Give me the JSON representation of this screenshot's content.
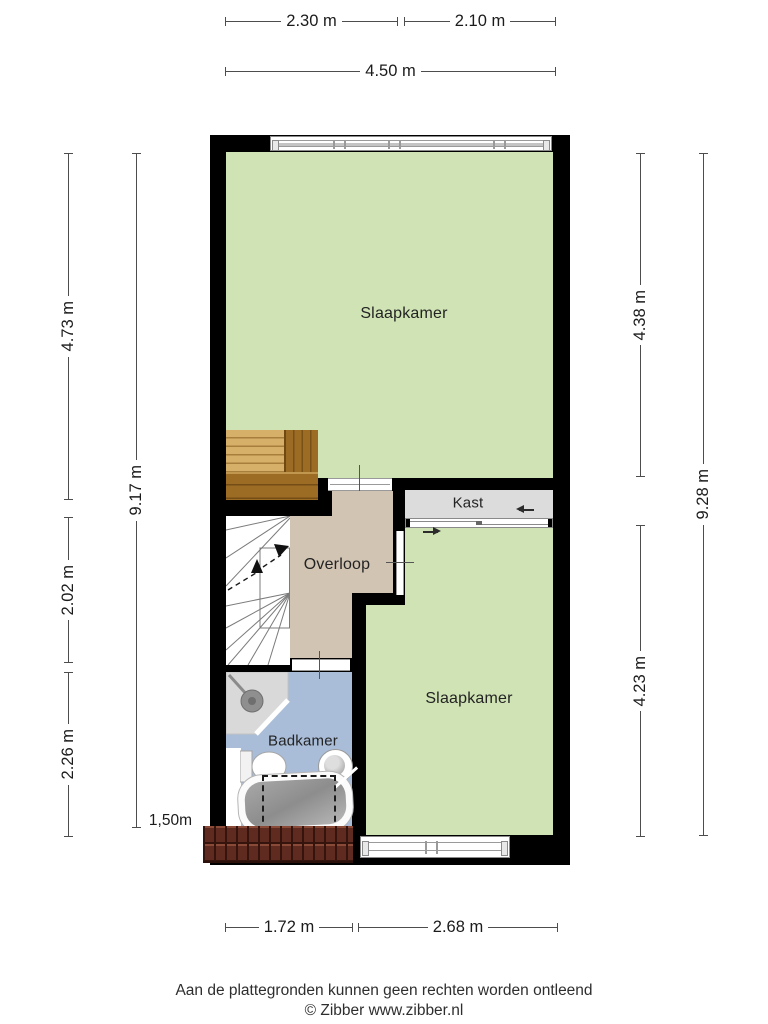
{
  "title": "Floor plan (verdieping)",
  "rooms": {
    "slaapkamer_top": "Slaapkamer",
    "kast": "Kast",
    "overloop": "Overloop",
    "slaapkamer_bottom": "Slaapkamer",
    "badkamer": "Badkamer"
  },
  "dimensions": {
    "top": [
      "2.30 m",
      "2.10 m",
      "4.50 m"
    ],
    "bottom": [
      "1.72 m",
      "2.68 m"
    ],
    "left": [
      "4.73 m",
      "9.17 m",
      "2.02 m",
      "2.26 m"
    ],
    "right": [
      "4.38 m",
      "9.28 m",
      "4.23 m"
    ],
    "headroom": "1,50m"
  },
  "footer": {
    "disclaimer": "Aan de plattegronden kunnen geen rechten worden ontleend",
    "credit": "© Zibber www.zibber.nl"
  },
  "colors": {
    "room-green": "#cfe3b4",
    "hallway-beige": "#d1c4b3",
    "closet-gray": "#dcdcdc",
    "bath-blue": "#a9bdd8",
    "wall-black": "#000000",
    "wood-light": "#d6b068",
    "wood-dark": "#9c6b24",
    "roof-tile": "#5f2a1f",
    "dim-line": "#4d4d4d"
  }
}
